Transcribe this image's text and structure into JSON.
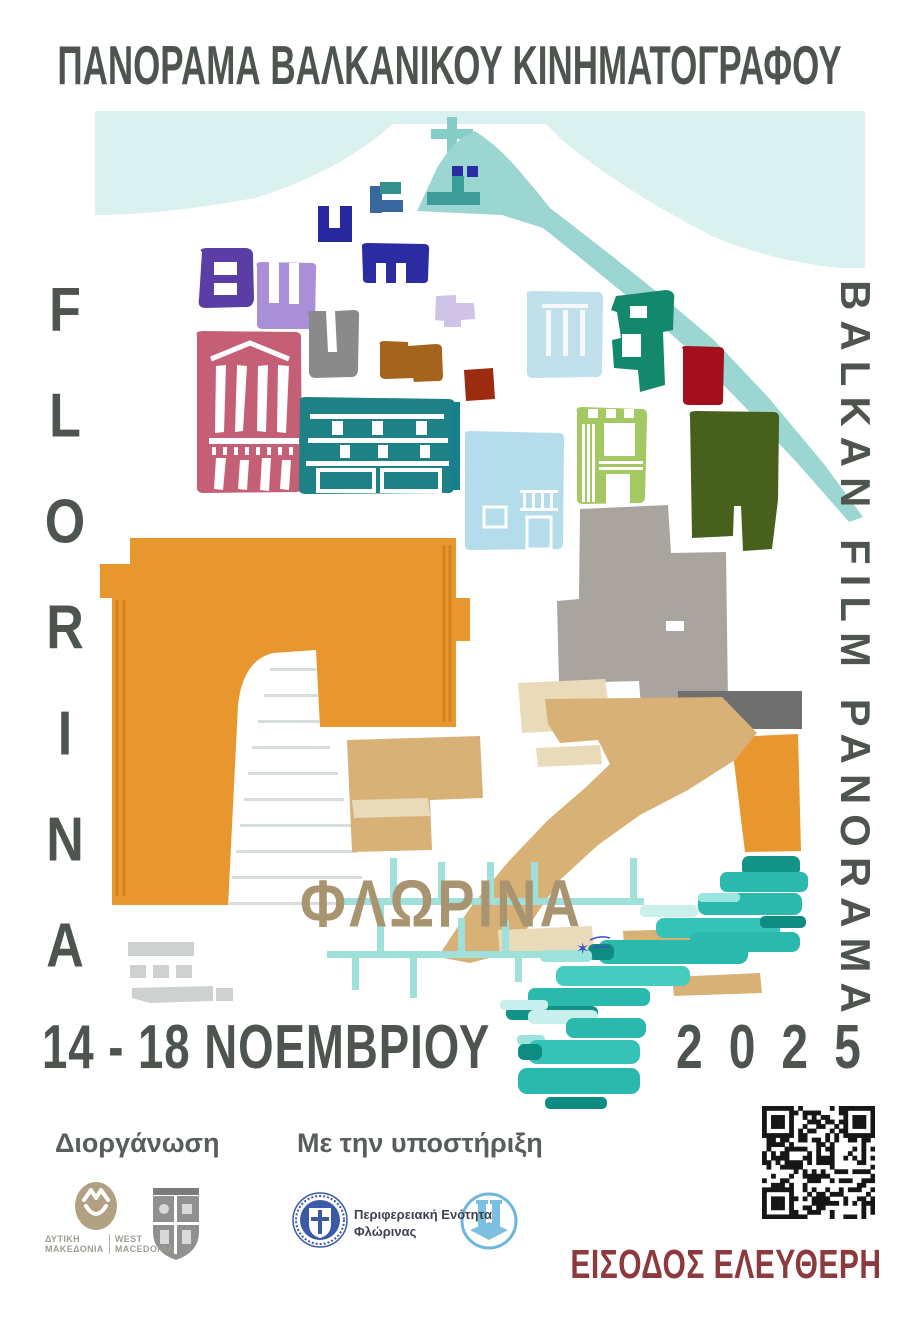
{
  "poster": {
    "top_title": "ΠΑΝΟΡΑΜΑ ΒΑΛΚΑΝΙΚΟΥ ΚΙΝΗΜΑΤΟΓΡΑΦΟΥ",
    "left_vertical_letters": [
      "F",
      "L",
      "O",
      "R",
      "I",
      "N",
      "A"
    ],
    "right_vertical_text": "BALKAN FILM PANORAMA",
    "city_name_greek": "ΦΛΩΡΙΝΑ",
    "date_range": "14 - 18 ΝΟΕΜΒΡΙΟΥ",
    "year": "2025",
    "free_entry": "ΕΙΣΟΔΟΣ ΕΛΕΥΘΕΡΗ"
  },
  "footer": {
    "organizer_heading": "Διοργάνωση",
    "support_heading": "Με την υποστήριξη",
    "west_macedonia": {
      "greek_line1": "ΔΥΤΙΚΗ",
      "greek_line2": "ΜΑΚΕΔΟΝΙΑ",
      "english_line1": "WEST",
      "english_line2": "MACEDONIA"
    },
    "support_org": {
      "line1": "Περιφερειακή Ενότητα",
      "line2": "Φλώρινας"
    },
    "icons": {
      "west_macedonia": "west-macedonia-emblem",
      "crest": "florina-municipality-crest",
      "greek_emblem": "hellenic-republic-emblem",
      "municipality": "florina-municipality-logo",
      "qr": "qr-code",
      "cross": "christian-cross",
      "signature": "artist-signature-star"
    }
  },
  "colors": {
    "title_gray": "#4e554f",
    "free_entry_red": "#8d3a3f",
    "city_tan": "#a99471",
    "arch_orange": "#e8962e",
    "hill_teal": "#9cd6d2",
    "sky_cyan": "#d9f1ef",
    "cascade_teal": "#2bb8ad",
    "road_tan": "#d8b176",
    "scaffold_teal": "#9fe0da"
  }
}
